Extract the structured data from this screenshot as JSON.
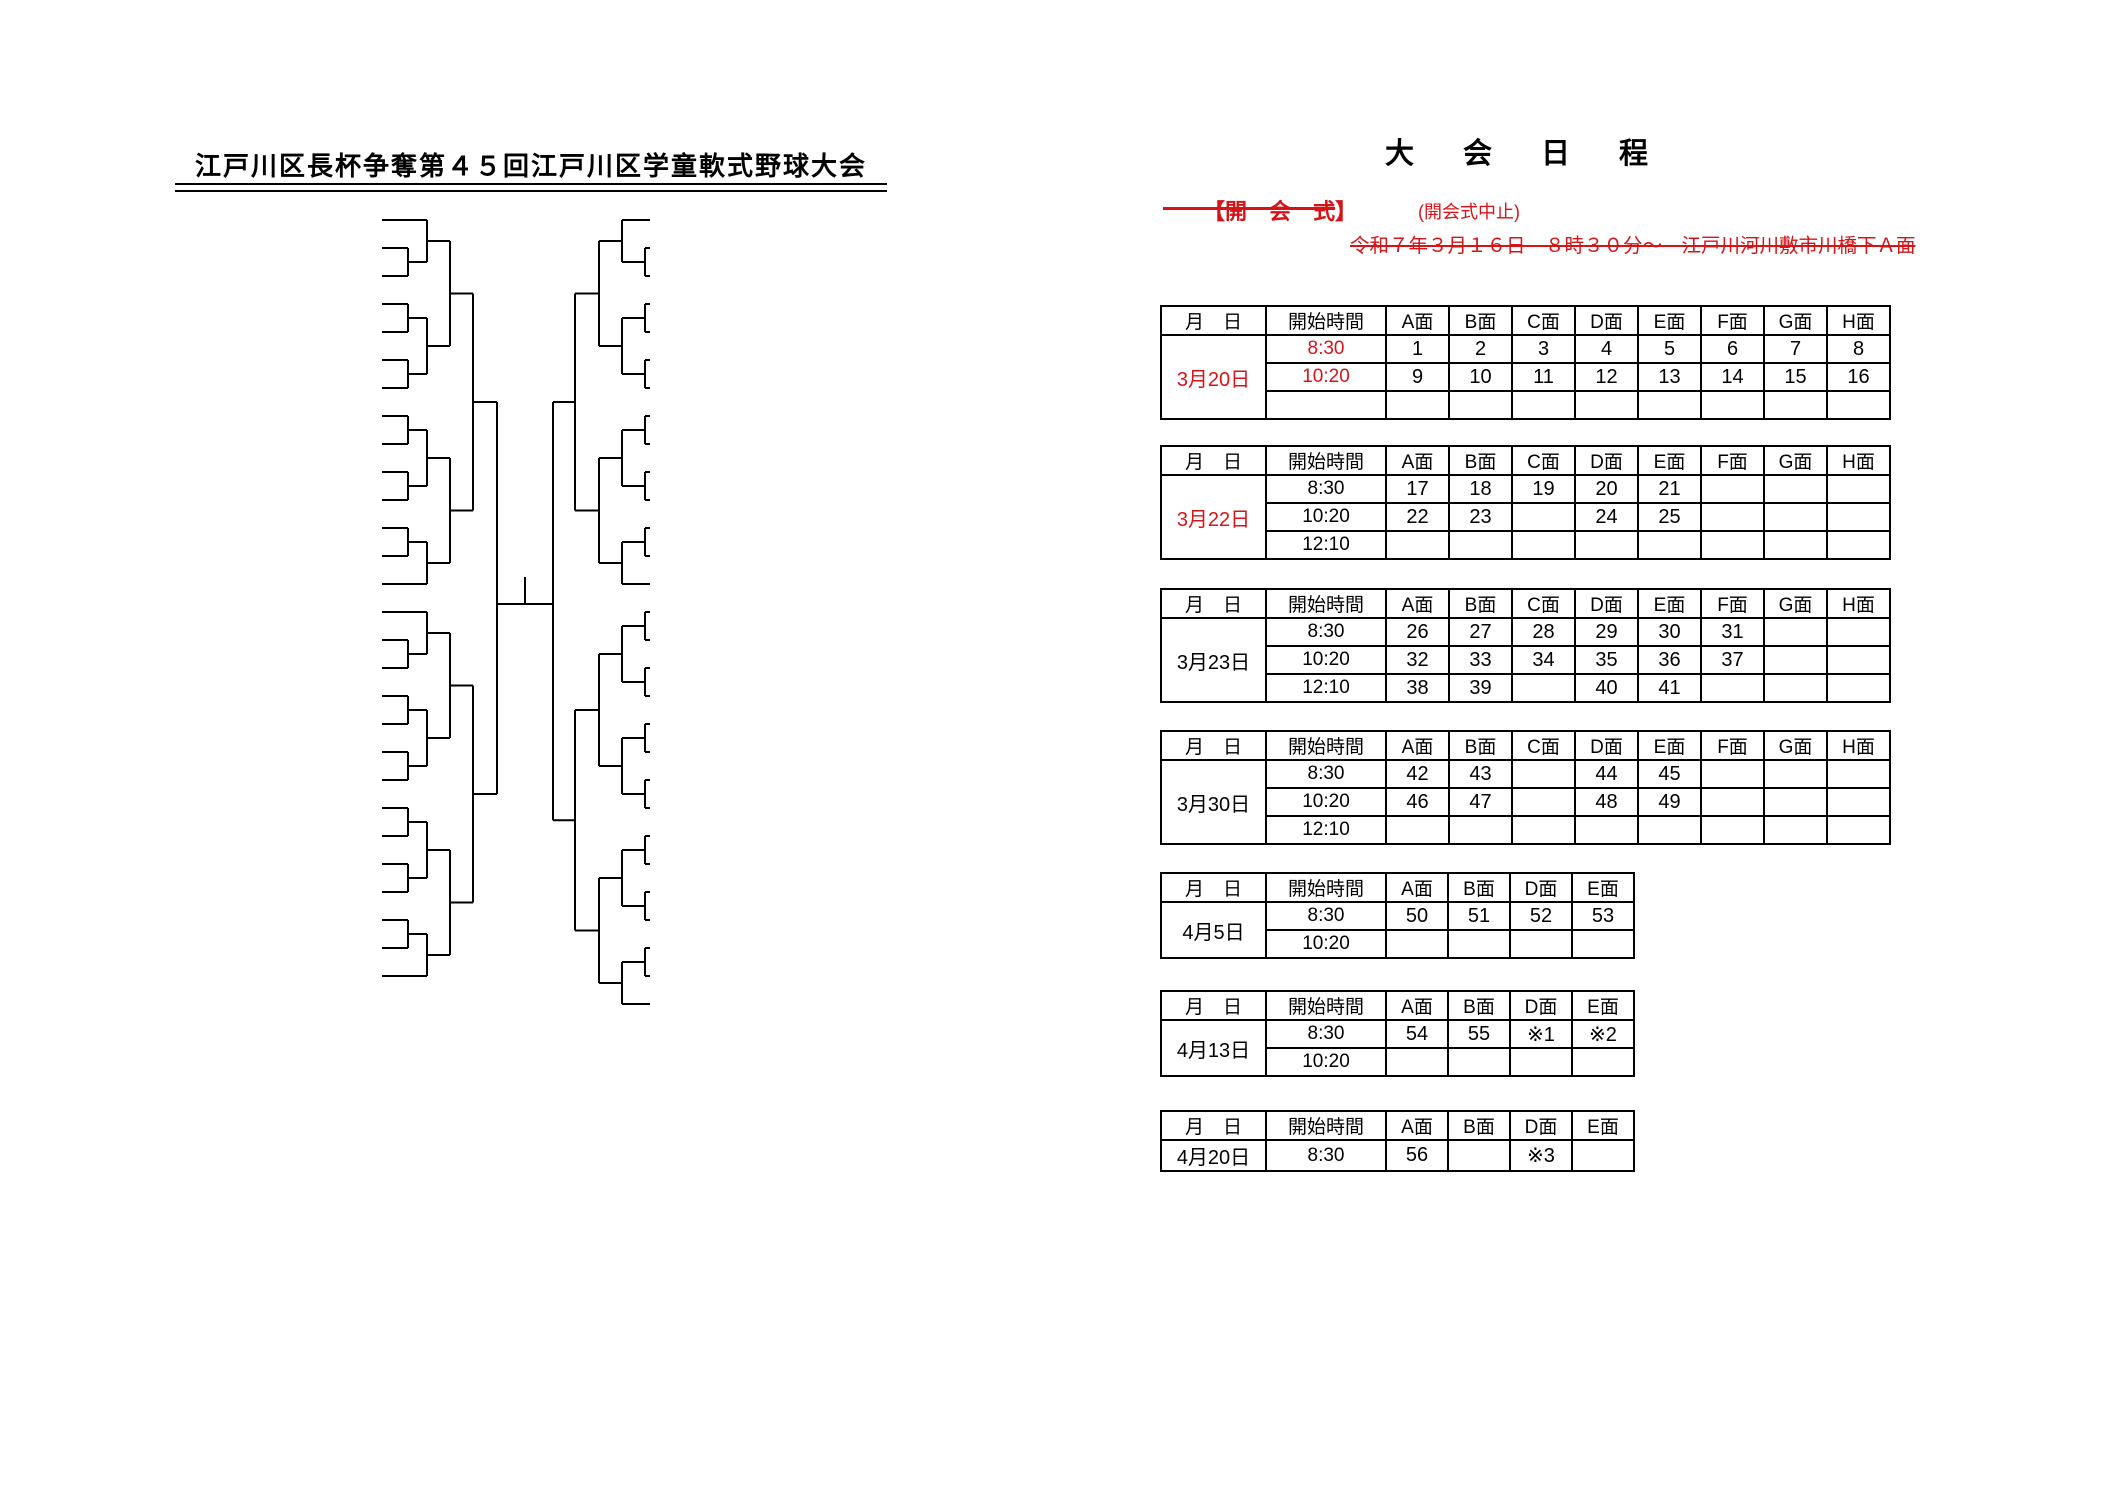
{
  "colors": {
    "ink": "#000000",
    "red": "#d61418"
  },
  "bracket": {
    "title": "江戸川区長杯争奪第４５回江戸川区学童軟式野球大会",
    "teams_left": [
      {
        "n": 1,
        "region": "葛西",
        "name": "葛西ファイターズA"
      },
      {
        "n": 2,
        "region": "小松川",
        "name": "ＢＬフェニックス"
      },
      {
        "n": 3,
        "region": "鹿骨",
        "name": "鹿骨三丁目スネークス"
      },
      {
        "n": 4,
        "region": "鹿骨",
        "name": "新堀ヒーローズ"
      },
      {
        "n": 5,
        "region": "鹿骨",
        "name": "本一色イーグルス"
      },
      {
        "n": 6,
        "region": "小松川",
        "name": "山彦エンゼルス"
      },
      {
        "n": 7,
        "region": "葛西",
        "name": "十八軒アトムズ"
      },
      {
        "n": 8,
        "region": "小松川",
        "name": "平井ビクトリーズ"
      },
      {
        "n": 9,
        "region": "葛西",
        "name": "船堀ダックスクラブ"
      },
      {
        "n": 10,
        "region": "篠崎",
        "name": "下篠レッズ"
      },
      {
        "n": 11,
        "region": "小松川",
        "name": "リトルファイターズ"
      },
      {
        "n": 12,
        "region": "篠崎",
        "name": "上篠崎ムスタングクラブ"
      },
      {
        "n": 13,
        "region": "",
        "name": "城東ベースボールクラブA"
      },
      {
        "n": 14,
        "region": "",
        "name": "城東ベースボールクラブB"
      },
      {
        "n": 15,
        "region": "葛西",
        "name": "清新ハンターズ"
      },
      {
        "n": 16,
        "region": "小岩",
        "name": "小岩マリオンズ"
      },
      {
        "n": 17,
        "region": "下鎌田",
        "name": "下鎌田イーグルス"
      },
      {
        "n": 18,
        "region": "小岩",
        "name": "ホワイトベルーガ"
      },
      {
        "n": 19,
        "region": "東部",
        "name": "瑞江スカイラーク"
      },
      {
        "n": 20,
        "region": "葛西",
        "name": "ゴールデンタイガー"
      },
      {
        "n": 21,
        "region": "松江",
        "name": "しらさぎ野球部"
      },
      {
        "n": 22,
        "region": "小岩",
        "name": "扇子田グリーンスターズ"
      },
      {
        "n": 23,
        "region": "篠崎",
        "name": "本郷キングス"
      },
      {
        "n": 24,
        "region": "葛西",
        "name": "葛西キラーズ"
      },
      {
        "n": 25,
        "region": "一之江",
        "name": "ゴールデン・F・ベイスターズ"
      },
      {
        "n": 26,
        "region": "松江",
        "name": "東松ファイターズ"
      },
      {
        "n": 27,
        "region": "葛西",
        "name": "ブルーシャークスクラブ"
      },
      {
        "n": 28,
        "region": "葛西",
        "name": "江戸川フットーズ"
      }
    ],
    "teams_right": [
      {
        "n": 29,
        "region": "葛西",
        "name": "雷サンダース"
      },
      {
        "n": 30,
        "region": "小岩",
        "name": "六中ファルコンズ"
      },
      {
        "n": 31,
        "region": "葛西",
        "name": "葛西ドジャース"
      },
      {
        "n": 32,
        "region": "篠崎",
        "name": "篠崎コンバット"
      },
      {
        "n": 33,
        "region": "葛西",
        "name": "江戸川ファイターズ"
      },
      {
        "n": 34,
        "region": "葛西",
        "name": "二小クラブ"
      },
      {
        "n": 35,
        "region": "小松川",
        "name": "平井西ドリームズ"
      },
      {
        "n": 36,
        "region": "篠崎",
        "name": "篠崎ホーマーズ"
      },
      {
        "n": 37,
        "region": "小岩",
        "name": "小岩サンダース"
      },
      {
        "n": 38,
        "region": "小岩",
        "name": "江戸川ジュニアリバーズ"
      },
      {
        "n": 39,
        "region": "東部",
        "name": "大雲寺スターズ"
      },
      {
        "n": 40,
        "region": "松江",
        "name": "大杉ビクトリー"
      },
      {
        "n": 41,
        "region": "小岩",
        "name": "小岩ＢＯＮＰ"
      },
      {
        "n": 42,
        "region": "篠崎",
        "name": "南篠崎ランチャーズ"
      },
      {
        "n": 43,
        "region": "下鎌田",
        "name": "下鎌田内手"
      },
      {
        "n": 44,
        "region": "葛西",
        "name": "七船スターズ"
      },
      {
        "n": 45,
        "region": "小岩",
        "name": "ホワイトホークス"
      },
      {
        "n": 46,
        "region": "小岩",
        "name": "一南スピリッツ"
      },
      {
        "n": 47,
        "region": "松江",
        "name": "松島ファルコンズ"
      },
      {
        "n": 48,
        "region": "松江",
        "name": "若人クラブ"
      },
      {
        "n": 49,
        "region": "小岩",
        "name": "ジュニアナインズ"
      },
      {
        "n": 50,
        "region": "一之江",
        "name": "オレンジイーグルス"
      },
      {
        "n": 51,
        "region": "小岩",
        "name": "ＫＧパワーズ"
      },
      {
        "n": 52,
        "region": "篠崎",
        "name": "篠崎スカイエッグス"
      },
      {
        "n": 53,
        "region": "下鎌田",
        "name": "椿パワーズ"
      },
      {
        "n": 54,
        "region": "小岩",
        "name": "レッドシャークス"
      },
      {
        "n": 55,
        "region": "葛西",
        "name": "葛西ファイターズB"
      },
      {
        "n": 56,
        "region": "小松川",
        "name": "キングドラゴンズ"
      },
      {
        "n": 57,
        "region": "鹿骨",
        "name": "興宮ファイターズ"
      }
    ],
    "matches_left": [
      {
        "g": 1,
        "r": 1,
        "a": "T2",
        "b": "T3"
      },
      {
        "g": 2,
        "r": 1,
        "a": "T4",
        "b": "T5"
      },
      {
        "g": 3,
        "r": 1,
        "a": "T6",
        "b": "T7"
      },
      {
        "g": 4,
        "r": 1,
        "a": "T8",
        "b": "T9"
      },
      {
        "g": 5,
        "r": 1,
        "a": "T10",
        "b": "T11"
      },
      {
        "g": 6,
        "r": 1,
        "a": "T12",
        "b": "T13"
      },
      {
        "g": 7,
        "r": 1,
        "a": "T16",
        "b": "T17"
      },
      {
        "g": 8,
        "r": 1,
        "a": "T18",
        "b": "T19"
      },
      {
        "g": 9,
        "r": 1,
        "a": "T20",
        "b": "T21"
      },
      {
        "g": 10,
        "r": 1,
        "a": "T22",
        "b": "T23"
      },
      {
        "g": 11,
        "r": 1,
        "a": "T24",
        "b": "T25"
      },
      {
        "g": 12,
        "r": 1,
        "a": "T26",
        "b": "T27"
      },
      {
        "g": 26,
        "r": 2,
        "a": "T1",
        "b": "G1"
      },
      {
        "g": 27,
        "r": 2,
        "a": "G2",
        "b": "G3"
      },
      {
        "g": 28,
        "r": 2,
        "a": "G4",
        "b": "G5"
      },
      {
        "g": 29,
        "r": 2,
        "a": "G6",
        "b": "T14"
      },
      {
        "g": 30,
        "r": 2,
        "a": "T15",
        "b": "G7"
      },
      {
        "g": 31,
        "r": 2,
        "a": "G8",
        "b": "G9"
      },
      {
        "g": 32,
        "r": 2,
        "a": "G10",
        "b": "G11"
      },
      {
        "g": 33,
        "r": 2,
        "a": "G12",
        "b": "T28"
      },
      {
        "g": 42,
        "r": 3,
        "a": "G26",
        "b": "G27"
      },
      {
        "g": 43,
        "r": 3,
        "a": "G28",
        "b": "G29"
      },
      {
        "g": 44,
        "r": 3,
        "a": "G30",
        "b": "G31"
      },
      {
        "g": 45,
        "r": 3,
        "a": "G32",
        "b": "G33"
      },
      {
        "g": 50,
        "r": 4,
        "a": "G42",
        "b": "G43"
      },
      {
        "g": 51,
        "r": 4,
        "a": "G44",
        "b": "G45"
      },
      {
        "g": 54,
        "r": 5,
        "a": "G50",
        "b": "G51"
      }
    ],
    "matches_right": [
      {
        "g": 13,
        "r": 1,
        "a": "T30",
        "b": "T31"
      },
      {
        "g": 14,
        "r": 1,
        "a": "T32",
        "b": "T33"
      },
      {
        "g": 15,
        "r": 1,
        "a": "T34",
        "b": "T35"
      },
      {
        "g": 16,
        "r": 1,
        "a": "T36",
        "b": "T37"
      },
      {
        "g": 17,
        "r": 1,
        "a": "T38",
        "b": "T39"
      },
      {
        "g": 18,
        "r": 1,
        "a": "T40",
        "b": "T41"
      },
      {
        "g": 19,
        "r": 1,
        "a": "T43",
        "b": "T44"
      },
      {
        "g": 20,
        "r": 1,
        "a": "T45",
        "b": "T46"
      },
      {
        "g": 21,
        "r": 1,
        "a": "T47",
        "b": "T48"
      },
      {
        "g": 22,
        "r": 1,
        "a": "T49",
        "b": "T50"
      },
      {
        "g": 23,
        "r": 1,
        "a": "T51",
        "b": "T52"
      },
      {
        "g": 24,
        "r": 1,
        "a": "T53",
        "b": "T54"
      },
      {
        "g": 25,
        "r": 1,
        "a": "T55",
        "b": "T56"
      },
      {
        "g": 34,
        "r": 2,
        "a": "T29",
        "b": "G13"
      },
      {
        "g": 35,
        "r": 2,
        "a": "G14",
        "b": "G15"
      },
      {
        "g": 36,
        "r": 2,
        "a": "G16",
        "b": "G17"
      },
      {
        "g": 37,
        "r": 2,
        "a": "G18",
        "b": "T42"
      },
      {
        "g": 38,
        "r": 2,
        "a": "G19",
        "b": "G20"
      },
      {
        "g": 39,
        "r": 2,
        "a": "G21",
        "b": "G22"
      },
      {
        "g": 40,
        "r": 2,
        "a": "G23",
        "b": "G24"
      },
      {
        "g": 41,
        "r": 2,
        "a": "G25",
        "b": "T57"
      },
      {
        "g": 46,
        "r": 3,
        "a": "G34",
        "b": "G35"
      },
      {
        "g": 47,
        "r": 3,
        "a": "G36",
        "b": "G37"
      },
      {
        "g": 48,
        "r": 3,
        "a": "G38",
        "b": "G39"
      },
      {
        "g": 49,
        "r": 3,
        "a": "G40",
        "b": "G41"
      },
      {
        "g": 52,
        "r": 4,
        "a": "G46",
        "b": "G47"
      },
      {
        "g": 53,
        "r": 4,
        "a": "G48",
        "b": "G49"
      },
      {
        "g": 55,
        "r": 5,
        "a": "G52",
        "b": "G53"
      }
    ],
    "final": {
      "game": 56
    }
  },
  "schedule": {
    "title": "大　会　日　程",
    "opening": {
      "label": "【開　会　式】",
      "cancel_note": "(開会式中止)",
      "details": "令和７年３月１６日　８時３０分～　江戸川河川敷市川橋下Ａ面"
    },
    "venue_label": "(市川橋下江戸川河川敷)",
    "header_date": "月　日",
    "header_time": "開始時間",
    "tables": [
      {
        "date": "3月20日",
        "date_red": true,
        "times_red": true,
        "cols": [
          "A面",
          "B面",
          "C面",
          "D面",
          "E面",
          "F面",
          "G面",
          "H面"
        ],
        "rows": [
          {
            "time": "8:30",
            "cells": [
              "1",
              "2",
              "3",
              "4",
              "5",
              "6",
              "7",
              "8"
            ]
          },
          {
            "time": "10:20",
            "cells": [
              "9",
              "10",
              "11",
              "12",
              "13",
              "14",
              "15",
              "16"
            ]
          },
          {
            "time": "",
            "cells": [
              "",
              "",
              "",
              "",
              "",
              "",
              "",
              ""
            ]
          }
        ]
      },
      {
        "date": "3月22日",
        "date_red": true,
        "times_red": false,
        "cols": [
          "A面",
          "B面",
          "C面",
          "D面",
          "E面",
          "F面",
          "G面",
          "H面"
        ],
        "rows": [
          {
            "time": "8:30",
            "cells": [
              "17",
              "18",
              "19",
              "20",
              "21",
              "",
              "",
              ""
            ]
          },
          {
            "time": "10:20",
            "cells": [
              "22",
              "23",
              "",
              "24",
              "25",
              "",
              "",
              ""
            ]
          },
          {
            "time": "12:10",
            "cells": [
              "",
              "",
              "",
              "",
              "",
              "",
              "",
              ""
            ]
          }
        ]
      },
      {
        "date": "3月23日",
        "date_red": false,
        "times_red": false,
        "cols": [
          "A面",
          "B面",
          "C面",
          "D面",
          "E面",
          "F面",
          "G面",
          "H面"
        ],
        "rows": [
          {
            "time": "8:30",
            "cells": [
              "26",
              "27",
              "28",
              "29",
              "30",
              "31",
              "",
              ""
            ]
          },
          {
            "time": "10:20",
            "cells": [
              "32",
              "33",
              "34",
              "35",
              "36",
              "37",
              "",
              ""
            ]
          },
          {
            "time": "12:10",
            "cells": [
              "38",
              "39",
              "",
              "40",
              "41",
              "",
              "",
              ""
            ]
          }
        ]
      },
      {
        "date": "3月30日",
        "date_red": false,
        "times_red": false,
        "cols": [
          "A面",
          "B面",
          "C面",
          "D面",
          "E面",
          "F面",
          "G面",
          "H面"
        ],
        "rows": [
          {
            "time": "8:30",
            "cells": [
              "42",
              "43",
              "",
              "44",
              "45",
              "",
              "",
              ""
            ]
          },
          {
            "time": "10:20",
            "cells": [
              "46",
              "47",
              "",
              "48",
              "49",
              "",
              "",
              ""
            ]
          },
          {
            "time": "12:10",
            "cells": [
              "",
              "",
              "",
              "",
              "",
              "",
              "",
              ""
            ]
          }
        ]
      },
      {
        "date": "4月5日",
        "date_red": false,
        "times_red": false,
        "cols": [
          "A面",
          "B面",
          "D面",
          "E面"
        ],
        "rows": [
          {
            "time": "8:30",
            "cells": [
              "50",
              "51",
              "52",
              "53"
            ]
          },
          {
            "time": "10:20",
            "cells": [
              "",
              "",
              "",
              ""
            ]
          }
        ]
      },
      {
        "date": "4月13日",
        "date_red": false,
        "times_red": false,
        "cols": [
          "A面",
          "B面",
          "D面",
          "E面"
        ],
        "rows": [
          {
            "time": "8:30",
            "cells": [
              "54",
              "55",
              "※1",
              "※2"
            ]
          },
          {
            "time": "10:20",
            "cells": [
              "",
              "",
              "",
              ""
            ]
          }
        ],
        "notes": [
          "※1　50負　対　52負",
          "※2　51負　対　53負"
        ]
      },
      {
        "date": "4月20日",
        "date_red": false,
        "times_red": false,
        "cols": [
          "A面",
          "B面",
          "D面",
          "E面"
        ],
        "rows": [
          {
            "time": "8:30",
            "cells": [
              "56",
              "",
              "※3",
              ""
            ]
          }
        ],
        "notes": [
          "※3　54負　対　55負"
        ]
      }
    ],
    "footer": {
      "title": "上部大会出場",
      "rows": [
        [
          "全日本東京都大会",
          "第一代表",
          "優勝チーム"
        ],
        [
          "",
          "第二代表",
          "準優勝チーム"
        ],
        [
          "",
          "第三代表",
          "※３の勝ちチーム"
        ],
        [
          "都知事杯東京都大会",
          "第一代表",
          "※３の負けチーム"
        ],
        [
          "",
          "第二代表",
          "※１の勝ちチーム"
        ],
        [
          "",
          "第三代表",
          "※２の勝ちチーム"
        ]
      ]
    }
  }
}
